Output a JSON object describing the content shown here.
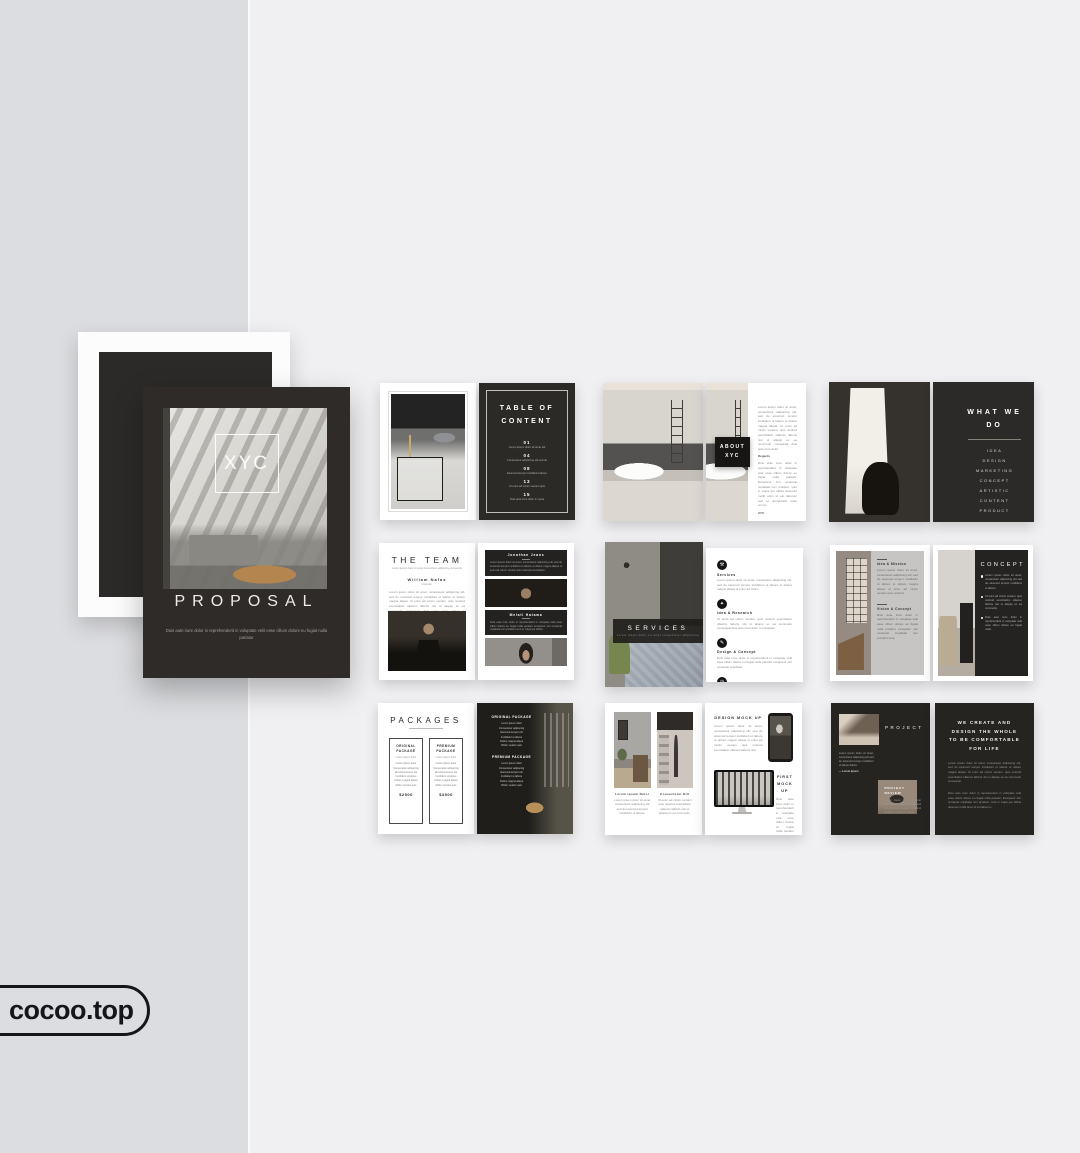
{
  "watermark": {
    "label": "cocoo.top"
  },
  "cover": {
    "logo": "XYC",
    "title": "PROPOSAL",
    "subtitle": "Duis aute irure dolor in reprehenderit in voluptate velit esse cillum dolore eu fugiat nulla pariatur"
  },
  "toc": {
    "title": "TABLE OF CONTENT",
    "items": [
      {
        "num": "01",
        "label": "Lorem ipsum dolor sit amet elit"
      },
      {
        "num": "04",
        "label": "Consectetur adipiscing elit sed do"
      },
      {
        "num": "08",
        "label": "Eiusmod tempor incididunt labore"
      },
      {
        "num": "13",
        "label": "Ut enim ad minim veniam quis"
      },
      {
        "num": "15",
        "label": "Duis aute irure dolor in venia"
      }
    ]
  },
  "about": {
    "label": "ABOUT XYC",
    "para1": "Lorem ipsum dolor sit amet, consectetur adipiscing elit, sed do eiusmod tempor incididunt ut labore et dolore magna aliqua. Ut enim ad minim veniam, quis nostrud exercitation ullamco laboris nisi ut aliquip ex ea commodo consequat duis aute irure dolor.",
    "sign": "Regards",
    "para2": "Duis aute irure dolor in reprehenderit in voluptate velit esse cillum dolore eu fugiat nulla pariatur. Excepteur sint occaecat cupidatat non proident, sunt in culpa qui officia deserunt mollit anim id est laborum sed ut perspiciatis unde omnis.",
    "sign2": "XYC"
  },
  "what_we_do": {
    "title": "WHAT WE DO",
    "items": [
      "IDEA",
      "DESIGN",
      "MARKETING",
      "CONCEPT",
      "ARTISTIC",
      "CONTENT",
      "PRODUCT"
    ]
  },
  "team": {
    "title": "THE TEAM",
    "subtitle": "Lorem ipsum dolor sit amet consectetur adipiscing elit sed do",
    "member1": {
      "name": "William Nafas",
      "role": "Founder",
      "bio": "Lorem ipsum dolor sit amet, consectetur adipiscing elit, sed do eiusmod tempor incididunt ut labore et dolore magna aliqua. Ut enim ad minim veniam, quis nostrud exercitation ullamco laboris nisi ut aliquip ex ea commodo consequat duis aute irure dolor in reprehenderit in voluptate."
    },
    "member2": {
      "name": "Jonathan Jeans",
      "role": "Creative Director",
      "bio": "Lorem ipsum dolor sit amet, consectetur adipiscing elit, sed do eiusmod tempor incididunt ut labore et dolore magna aliqua ut enim ad minim veniam quis nostrud exercitation."
    },
    "member3": {
      "name": "Melati Hatawa",
      "role": "Art Director",
      "bio": "Duis aute irure dolor in reprehenderit in voluptate velit esse cillum dolore eu fugiat nulla pariatur excepteur sint occaecat cupidatat non proident sunt in culpa qui officia."
    }
  },
  "services": {
    "title": "SERVICES",
    "subtitle": "Lorem ipsum dolor sit amet consectetur adipiscing",
    "items": [
      {
        "glyph": "⚒",
        "label": "Services",
        "text": "Lorem ipsum dolor sit amet, consectetur adipiscing elit, sed do eiusmod tempor incididunt ut labore et dolore magna aliqua ut enim ad minim."
      },
      {
        "glyph": "✦",
        "label": "Idea & Research",
        "text": "Ut enim ad minim veniam, quis nostrud exercitation ullamco laboris nisi ut aliquip ex ea commodo consequat duis aute irure dolor in voluptate."
      },
      {
        "glyph": "✎",
        "label": "Design & Concept",
        "text": "Duis aute irure dolor in reprehenderit in voluptate velit esse cillum dolore eu fugiat nulla pariatur excepteur sint occaecat cupidatat."
      },
      {
        "glyph": "◷",
        "label": "Time Management",
        "text": "Excepteur sint occaecat cupidatat non proident, sunt in culpa qui officia deserunt mollit anim id est laborum sed ut perspiciatis unde."
      }
    ]
  },
  "concept": {
    "sections": [
      {
        "title": "Idea & Mission",
        "text": "Lorem ipsum dolor sit amet, consectetur adipiscing elit, sed do eiusmod tempor incididunt ut labore et dolore magna aliqua ut enim ad minim veniam quis nostrud."
      },
      {
        "title": "Vision & Concept",
        "text": "Duis aute irure dolor in reprehenderit in voluptate velit esse cillum dolore eu fugiat nulla pariatur excepteur sint occaecat cupidatat non proident sunt."
      }
    ],
    "title": "CONCEPT",
    "bullets": [
      "Lorem ipsum dolor sit amet, consectetur adipiscing elit sed do eiusmod tempor incididunt ut labore.",
      "Ut enim ad minim veniam, quis nostrud exercitation ullamco laboris nisi ut aliquip ex ea commodo.",
      "Duis aute irure dolor in reprehenderit in voluptate velit esse cillum dolore eu fugiat nulla."
    ]
  },
  "packages": {
    "title": "PACKAGES",
    "plans": [
      {
        "name": "ORIGINAL PACKAGE",
        "tag": "Lorem ipsum dolor",
        "features": "Lorem ipsum dolor\nConsectetur adipiscing\nEiusmod tempor elit\nIncididunt ut labore\nDolore magna aliqua\nMinim veniam quis",
        "price": "$2500"
      },
      {
        "name": "PREMIUM PACKAGE",
        "tag": "Lorem ipsum dolor",
        "features": "Lorem ipsum dolor\nConsectetur adipiscing\nEiusmod tempor elit\nIncididunt ut labore\nDolore magna aliqua\nMinim veniam quis",
        "price": "$3500"
      }
    ]
  },
  "mockups": {
    "captions": [
      {
        "title": "Lorem Ipsum Dolor",
        "text": "Lorem ipsum dolor sit amet consectetur adipiscing elit sed do eiusmod tempor incididunt ut labore."
      },
      {
        "title": "Consectetur Elit",
        "text": "Ut enim ad minim veniam quis nostrud exercitation ullamco laboris nisi ut aliquip ex ea commodo."
      }
    ],
    "design": {
      "title": "DESIGN MOCK UP",
      "text": "Lorem ipsum dolor sit amet, consectetur adipiscing elit, sed do eiusmod tempor incididunt ut labore et dolore magna aliqua ut enim ad minim veniam quis nostrud exercitation ullamco laboris nisi."
    },
    "first": {
      "title": "FIRST MOCK UP",
      "text": "Duis aute irure dolor in reprehenderit in voluptate velit esse cillum dolore eu fugiat nulla pariatur excepteur sint occaecat cupidatat non proident sunt in culpa qui officia deserunt."
    }
  },
  "product": {
    "label": "PROJECT",
    "quote": "Lorem ipsum dolor sit amet, consectetur adipiscing elit sed do eiusmod tempor incididunt ut labore dolore.",
    "quote_sign": "— Lorem Ipsum",
    "review_title": "PROJECT REVIEW",
    "review_text": "Lorem ipsum dolor sit amet consectetur adipiscing elit sed do eiusmod tempor incididunt ut labore et dolore magna.",
    "headline": "WE CREATE AND DESIGN THE WHOLE TO BE COMFORTABLE FOR LIFE",
    "para1": "Lorem ipsum dolor sit amet, consectetur adipiscing elit, sed do eiusmod tempor incididunt ut labore et dolore magna aliqua. Ut enim ad minim veniam, quis nostrud exercitation ullamco laboris nisi ut aliquip ex ea commodo consequat.",
    "para2": "Duis aute irure dolor in reprehenderit in voluptate velit esse cillum dolore eu fugiat nulla pariatur. Excepteur sint occaecat cupidatat non proident, sunt in culpa qui officia deserunt mollit anim id est laborum."
  }
}
